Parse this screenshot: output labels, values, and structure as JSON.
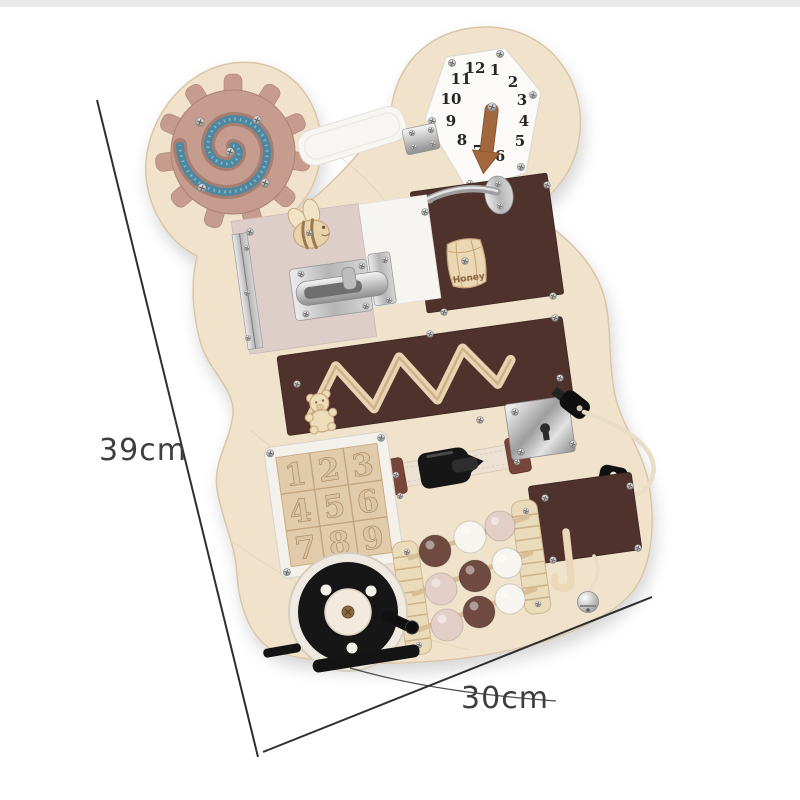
{
  "annotations": {
    "height_label": "39cm",
    "width_label": "30cm"
  },
  "board": {
    "clock": {
      "numbers": [
        "12",
        "1",
        "2",
        "3",
        "4",
        "5",
        "6",
        "7",
        "8",
        "9",
        "10",
        "11"
      ]
    },
    "puzzle": {
      "numbers": [
        "1",
        "2",
        "3",
        "4",
        "5",
        "6",
        "7",
        "8",
        "9"
      ]
    },
    "honey_label": "Honey",
    "beads": {
      "rows": [
        [
          "brown",
          "white",
          "pink"
        ],
        [
          "pink",
          "brown",
          "white"
        ],
        [
          "pink",
          "brown",
          "white"
        ]
      ]
    },
    "toys": [
      "gear-spinner",
      "clock",
      "velcro-strip",
      "hook-latch",
      "honey-barrel",
      "bee",
      "bolt-latch",
      "piano-hinge",
      "zigzag-maze",
      "teddy-slider",
      "buckle-strap",
      "door-lock-with-keys",
      "number-puzzle",
      "abacus-beads",
      "fishing-reel",
      "hook-panel-with-bell"
    ]
  },
  "colors": {
    "background": "#ffffff",
    "wood": "#f0e2cb",
    "wood_edge": "#d8c2a3",
    "panel_brown": "#4f322b",
    "panel_pink": "#ddcec9",
    "panel_white": "#f7f5f1",
    "gear_pink": "#c59c8e",
    "spiral_blue": "#4e87a0",
    "strap": "#ece1d2",
    "anchor_brown": "#78453a",
    "toy_black": "#161616",
    "dimension_line": "#2f2f2f",
    "label_text": "#3e3e3e",
    "beads": {
      "brown": "#6e4a41",
      "white": "#f7f5f0",
      "pink": "#e4cfc8"
    }
  }
}
